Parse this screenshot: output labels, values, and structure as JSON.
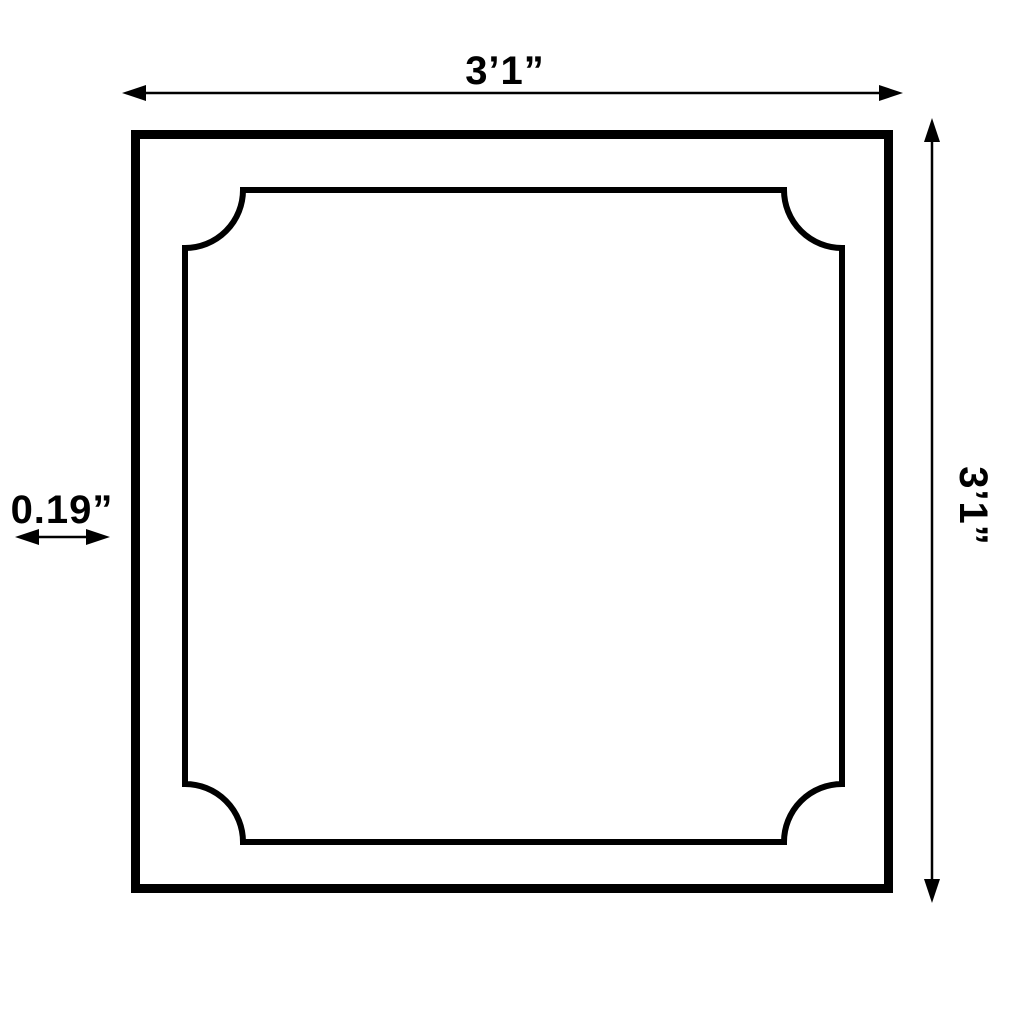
{
  "diagram": {
    "colors": {
      "line": "#000000",
      "background": "#ffffff"
    },
    "dimensions": {
      "width_label": "3’1”",
      "height_label": "3’1”",
      "thickness_label": "0.19”"
    }
  }
}
